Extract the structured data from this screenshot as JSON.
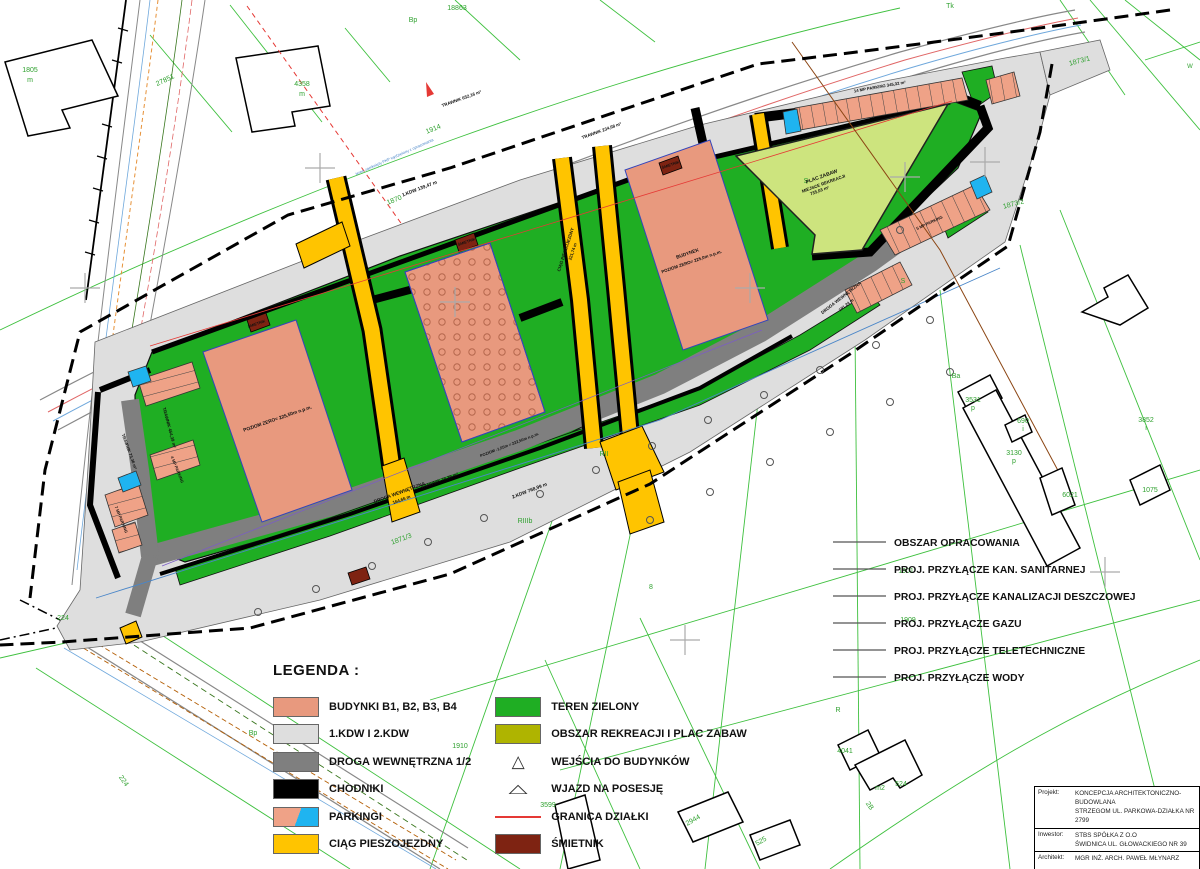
{
  "palette": {
    "building": "#E8997E",
    "kdw": "#DEDEDE",
    "road": "#7F7F7F",
    "sidewalk": "#000000",
    "parking_salmon": "#EFA287",
    "parking_blue": "#1FB4F0",
    "path_yellow": "#FFC400",
    "green": "#1FAE23",
    "recreation": "#AFB400",
    "playground": "#CDE47E",
    "bin": "#7E2312",
    "boundary_red": "#E53935",
    "cad_green": "#2FA12F"
  },
  "legend": {
    "title": "LEGENDA :",
    "left": [
      {
        "label": "BUDYNKI B1, B2, B3, B4",
        "type": "block",
        "color": "#E8997E"
      },
      {
        "label": "1.KDW I 2.KDW",
        "type": "block",
        "color": "#DEDEDE"
      },
      {
        "label": "DROGA WEWNĘTRZNA 1/2",
        "type": "block",
        "color": "#7F7F7F"
      },
      {
        "label": "CHODNIKI",
        "type": "block",
        "color": "#000000"
      },
      {
        "label": "PARKINGI",
        "type": "split",
        "colors": [
          "#EFA287",
          "#1FB4F0"
        ]
      },
      {
        "label": "CIĄG PIESZOJEZDNY",
        "type": "block",
        "color": "#FFC400"
      }
    ],
    "right": [
      {
        "label": "TEREN ZIELONY",
        "type": "block",
        "color": "#1FAE23"
      },
      {
        "label": "OBSZAR REKREACJI I PLAC ZABAW",
        "type": "block",
        "color": "#AFB400"
      },
      {
        "label": "WEJŚCIA DO BUDYNKÓW",
        "type": "triangle"
      },
      {
        "label": "WJAZD NA POSESJĘ",
        "type": "triangle_wide"
      },
      {
        "label": "GRANICA DZIAŁKI",
        "type": "line",
        "color": "#E53935"
      },
      {
        "label": "ŚMIETNIK",
        "type": "block",
        "color": "#7E2312"
      }
    ]
  },
  "line_legend": {
    "items": [
      "OBSZAR OPRACOWANIA",
      "PROJ. PRZYŁĄCZE KAN. SANITARNEJ",
      "PROJ. PRZYŁĄCZE KANALIZACJI DESZCZOWEJ",
      "PROJ. PRZYŁĄCZE GAZU",
      "PROJ. PRZYŁĄCZE TELETECHNICZNE",
      "PROJ. PRZYŁĄCZE WODY"
    ]
  },
  "title_block": {
    "projekt_label": "Projekt:",
    "projekt_line1": "KONCEPCJA ARCHITEKTONICZNO-BUDOWLANA",
    "projekt_line2": "STRZEGOM UL. PARKOWA-DZIAŁKA NR 2799",
    "inwestor_label": "Inwestor:",
    "inwestor_line1": "STBS SPÓŁKA Z O.O",
    "inwestor_line2": "ŚWIDNICA UL. GŁOWACKIEGO NR 39",
    "architekt_label": "Architekt:",
    "architekt_line1": "MGR INŻ. ARCH. PAWEŁ MŁYNARZ",
    "nazwa_label": "Nazwa pliku:",
    "nazwa_value": "PROJEKT ZAGOSPODAROWANIA TERENU",
    "skala_label": "Skala:",
    "skala_value": "1 : 500",
    "data_label": "Data:",
    "data_value": "2.11.2021",
    "rys_value": "RYS. NR 1"
  },
  "map_labels": [
    {
      "t": "18863",
      "x": 457,
      "y": 10
    },
    {
      "t": "Tk",
      "x": 950,
      "y": 8
    },
    {
      "t": "Bp",
      "x": 413,
      "y": 22
    },
    {
      "t": "1873/1",
      "x": 1080,
      "y": 63,
      "r": -15
    },
    {
      "t": "1873/2",
      "x": 1014,
      "y": 206,
      "r": -15
    },
    {
      "t": "1914",
      "x": 434,
      "y": 131,
      "r": -22
    },
    {
      "t": "1870",
      "x": 395,
      "y": 202,
      "r": -22
    },
    {
      "t": "1871/3",
      "x": 402,
      "y": 541,
      "r": -20
    },
    {
      "t": "224",
      "x": 63,
      "y": 620
    },
    {
      "t": "224",
      "x": 122,
      "y": 782,
      "r": 55
    },
    {
      "t": "RII",
      "x": 604,
      "y": 456
    },
    {
      "t": "RIIIb",
      "x": 525,
      "y": 523
    },
    {
      "t": "R",
      "x": 838,
      "y": 712
    },
    {
      "t": "Bp",
      "x": 253,
      "y": 735
    },
    {
      "t": "S",
      "x": 903,
      "y": 283
    },
    {
      "t": "S",
      "x": 806,
      "y": 183
    },
    {
      "t": "8",
      "x": 651,
      "y": 589
    },
    {
      "t": "1901",
      "x": 906,
      "y": 573
    },
    {
      "t": "1909",
      "x": 908,
      "y": 622
    },
    {
      "t": "1910",
      "x": 460,
      "y": 748
    },
    {
      "t": "3599",
      "x": 548,
      "y": 807
    },
    {
      "t": "2944",
      "x": 694,
      "y": 822,
      "r": -30
    },
    {
      "t": "525",
      "x": 762,
      "y": 843,
      "r": -30
    },
    {
      "t": "4041",
      "x": 845,
      "y": 753
    },
    {
      "t": "m2",
      "x": 880,
      "y": 790
    },
    {
      "t": "524",
      "x": 901,
      "y": 786
    },
    {
      "t": "2B",
      "x": 868,
      "y": 807,
      "r": 55
    },
    {
      "t": "3531",
      "x": 973,
      "y": 402
    },
    {
      "t": "p",
      "x": 973,
      "y": 410
    },
    {
      "t": "690",
      "x": 1023,
      "y": 423
    },
    {
      "t": "i",
      "x": 1023,
      "y": 431
    },
    {
      "t": "3130",
      "x": 1014,
      "y": 455
    },
    {
      "t": "p",
      "x": 1014,
      "y": 463
    },
    {
      "t": "3852",
      "x": 1146,
      "y": 422
    },
    {
      "t": "i",
      "x": 1146,
      "y": 430
    },
    {
      "t": "1075",
      "x": 1150,
      "y": 492
    },
    {
      "t": "6021",
      "x": 1070,
      "y": 497
    },
    {
      "t": "4358",
      "x": 302,
      "y": 86
    },
    {
      "t": "m",
      "x": 302,
      "y": 96
    },
    {
      "t": "1805",
      "x": 30,
      "y": 72
    },
    {
      "t": "m",
      "x": 30,
      "y": 82
    },
    {
      "t": "27851",
      "x": 166,
      "y": 82,
      "r": -25
    },
    {
      "t": "Ba",
      "x": 956,
      "y": 378
    },
    {
      "t": "W",
      "x": 1190,
      "y": 68,
      "s": 6
    },
    {
      "t": "PLAC ZABAW",
      "x": 822,
      "y": 178,
      "r": -20,
      "s": 5,
      "c": "#111",
      "w": 1
    },
    {
      "t": "MIEJSCE REKREACJI",
      "x": 824,
      "y": 185,
      "r": -20,
      "s": 4.4,
      "c": "#111",
      "w": 1
    },
    {
      "t": "735,03 m²",
      "x": 820,
      "y": 192,
      "r": -20,
      "s": 4.4,
      "c": "#111",
      "w": 1
    },
    {
      "t": "POZIOM ZERO= 225,50m n.p.m.",
      "x": 278,
      "y": 420,
      "r": -19,
      "s": 4.8,
      "c": "#111",
      "w": 1
    },
    {
      "t": "BUDYNEK",
      "x": 688,
      "y": 255,
      "r": -19,
      "s": 4.8,
      "c": "#111",
      "w": 1
    },
    {
      "t": "POZIOM ZERO= 225,0m n.p.m.",
      "x": 692,
      "y": 263,
      "r": -19,
      "s": 4.4,
      "c": "#111",
      "w": 1
    },
    {
      "t": "DROGA WEWNĘTRZNA",
      "x": 400,
      "y": 494,
      "r": -20,
      "s": 4.8,
      "c": "#111",
      "w": 1
    },
    {
      "t": "164,66 m",
      "x": 402,
      "y": 501,
      "r": -20,
      "s": 4.4,
      "c": "#111",
      "w": 1
    },
    {
      "t": "DROGA WEWNĘTRZNA",
      "x": 842,
      "y": 299,
      "r": -38,
      "s": 4.4,
      "c": "#111",
      "w": 1
    },
    {
      "t": "191,24 m",
      "x": 847,
      "y": 306,
      "r": -38,
      "s": 4.2,
      "c": "#111",
      "w": 1
    },
    {
      "t": "CIĄG PIESZOJEZDNY",
      "x": 567,
      "y": 250,
      "r": -72,
      "s": 4.4,
      "c": "#111",
      "w": 1
    },
    {
      "t": "221,74 m",
      "x": 574,
      "y": 252,
      "r": -72,
      "s": 4.2,
      "c": "#111",
      "w": 1
    },
    {
      "t": "TRAWNIK 652,16 m²",
      "x": 462,
      "y": 100,
      "r": -20,
      "s": 4.4,
      "c": "#111",
      "w": 1
    },
    {
      "t": "TRAWNIK 234,68 m²",
      "x": 602,
      "y": 132,
      "r": -20,
      "s": 4.4,
      "c": "#111",
      "w": 1
    },
    {
      "t": "TRAWNIK 454,39 m²",
      "x": 168,
      "y": 428,
      "r": 75,
      "s": 4.4,
      "c": "#111",
      "w": 1
    },
    {
      "t": "TRAWNIK 78,39 m²",
      "x": 440,
      "y": 482,
      "r": -20,
      "s": 4.4,
      "c": "#111",
      "w": 1
    },
    {
      "t": "TRAWNIK 73,36 m²",
      "x": 128,
      "y": 452,
      "r": 70,
      "s": 4.2,
      "c": "#111",
      "w": 1
    },
    {
      "t": "1.KDW 139,47 m",
      "x": 420,
      "y": 190,
      "r": -21,
      "s": 4.8,
      "c": "#111",
      "w": 1
    },
    {
      "t": "2.KDW 768,99 m",
      "x": 530,
      "y": 492,
      "r": -21,
      "s": 4.8,
      "c": "#111",
      "w": 1
    },
    {
      "t": "14 MP PARKING 345,32 m²",
      "x": 880,
      "y": 88,
      "r": -10,
      "s": 4.2,
      "c": "#111",
      "w": 1
    },
    {
      "t": "4 MP PARKING",
      "x": 176,
      "y": 470,
      "r": 68,
      "s": 4,
      "c": "#111",
      "w": 1
    },
    {
      "t": "7 MP PARKING",
      "x": 120,
      "y": 520,
      "r": 68,
      "s": 4,
      "c": "#111",
      "w": 1
    },
    {
      "t": "5 MP PARKING",
      "x": 930,
      "y": 224,
      "r": -25,
      "s": 4,
      "c": "#111",
      "w": 1
    },
    {
      "t": "ŚMIETNIK",
      "x": 257,
      "y": 325,
      "r": -19,
      "s": 3.8,
      "c": "#111",
      "w": 1
    },
    {
      "t": "ŚMIETNIK",
      "x": 467,
      "y": 243,
      "r": -19,
      "s": 3.8,
      "c": "#111",
      "w": 1
    },
    {
      "t": "ŚMIETNIK",
      "x": 671,
      "y": 166,
      "r": -19,
      "s": 3.8,
      "c": "#111",
      "w": 1
    },
    {
      "t": "POZIOM -1,05m = 222,50m n.p.m.",
      "x": 510,
      "y": 446,
      "r": -21,
      "s": 4,
      "c": "#111",
      "w": 1
    },
    {
      "t": "teren zamknięty PKP wydzielony z opracowania",
      "x": 395,
      "y": 158,
      "r": -24,
      "s": 4,
      "c": "#4A86C8"
    }
  ]
}
